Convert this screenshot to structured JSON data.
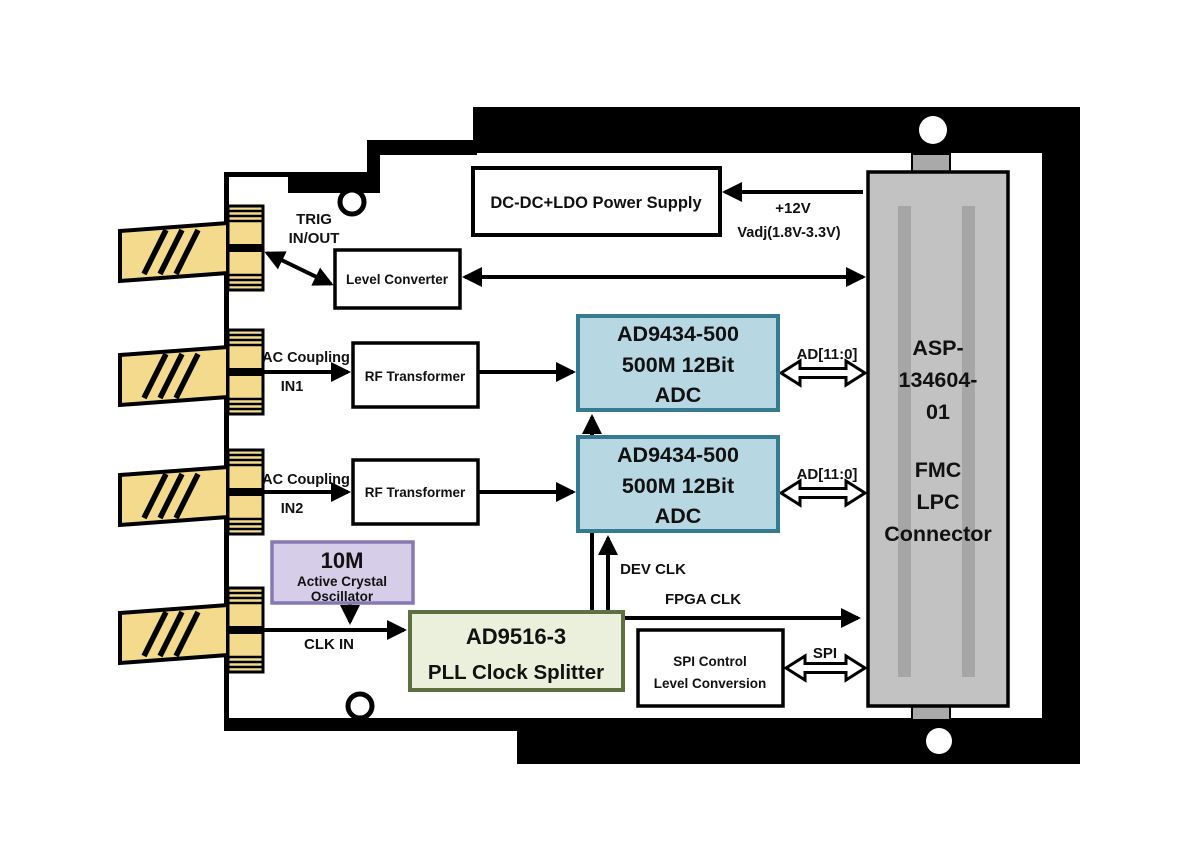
{
  "blocks": {
    "power_supply": {
      "label": "DC-DC+LDO Power Supply"
    },
    "level_converter": {
      "label": "Level Converter"
    },
    "rf_transformer_1": {
      "label": "RF Transformer"
    },
    "rf_transformer_2": {
      "label": "RF Transformer"
    },
    "adc_1": {
      "lines": [
        "AD9434-500",
        "500M 12Bit",
        "ADC"
      ]
    },
    "adc_2": {
      "lines": [
        "AD9434-500",
        "500M 12Bit",
        "ADC"
      ]
    },
    "oscillator": {
      "lines": [
        "10M",
        "Active Crystal",
        "Oscillator"
      ]
    },
    "pll": {
      "lines": [
        "AD9516-3",
        "PLL Clock Splitter"
      ]
    },
    "spi_control": {
      "lines": [
        "SPI Control",
        "Level Conversion"
      ]
    },
    "fmc_connector": {
      "lines": [
        "ASP-",
        "134604-",
        "01",
        "FMC",
        "LPC",
        "Connector"
      ]
    }
  },
  "labels": {
    "trig": {
      "line1": "TRIG",
      "line2": "IN/OUT"
    },
    "power": {
      "line1": "+12V",
      "line2": "Vadj(1.8V-3.3V)"
    },
    "in1": {
      "top": "AC Coupling",
      "bottom": "IN1"
    },
    "in2": {
      "top": "AC Coupling",
      "bottom": "IN2"
    },
    "clk_in": "CLK IN",
    "ad_bus_1": "AD[11:0]",
    "ad_bus_2": "AD[11:0]",
    "dev_clk": "DEV CLK",
    "fpga_clk": "FPGA CLK",
    "spi": "SPI"
  },
  "colors": {
    "outline_black": "#000000",
    "box_white": "#ffffff",
    "connector_yellow": "#f4da8c",
    "adc_fill": "#b7d8e3",
    "adc_border": "#357a8e",
    "oscillator_fill": "#d6cde8",
    "oscillator_border": "#8678b2",
    "pll_fill": "#eaf0dc",
    "pll_border": "#5f7040",
    "fmc_fill": "#c2c2c2",
    "fmc_stripe": "#a6a6a6",
    "fmc_tab": "#a9a9a9"
  }
}
